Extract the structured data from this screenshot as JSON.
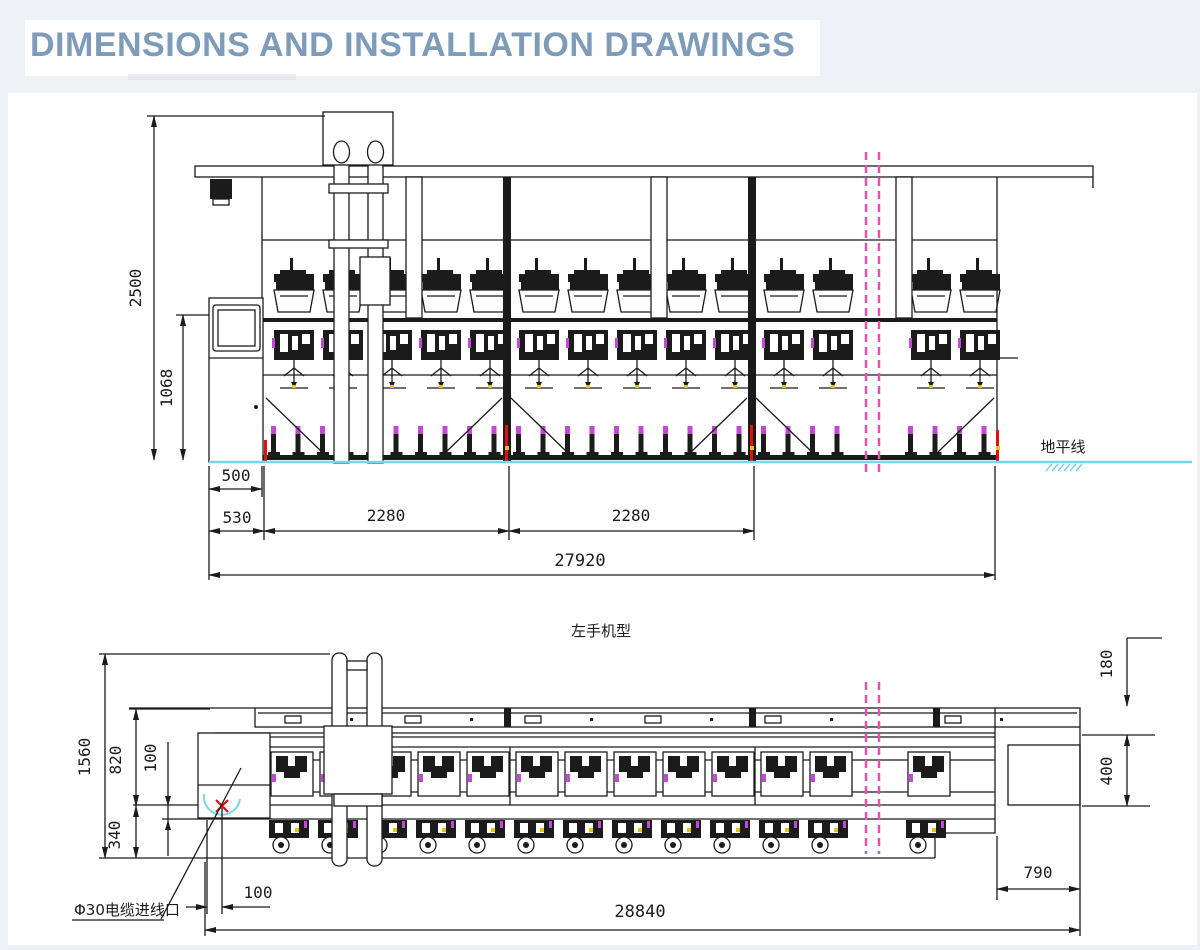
{
  "page": {
    "title": "DIMENSIONS AND INSTALLATION DRAWINGS"
  },
  "colors": {
    "title": "#7e9cba",
    "page_background": "#eef1f5",
    "line": "#1b1b1b",
    "ground_cyan": "#79d5e8",
    "break_magenta": "#e650b2",
    "accent_magenta": "#c24ad2",
    "mark_red": "#e01010",
    "mark_yellow": "#e6c412"
  },
  "top_drawing": {
    "name": "side elevation",
    "ground_label": "地平线",
    "dims": {
      "overall_height": "2500",
      "spindle_height": "1068",
      "cabinet_width": "500",
      "head_section": "530",
      "section_a": "2280",
      "section_b": "2280",
      "overall_length": "27920"
    }
  },
  "bottom_drawing": {
    "view_title": "左手机型",
    "cable_note": "Φ30电缆进线口",
    "dims": {
      "overall_width": "1560",
      "frame_width": "820",
      "inner_offset": "100",
      "rail_offset": "340",
      "top_offset": "180",
      "rail_width": "400",
      "cable_offset": "100",
      "rail_extension": "790",
      "overall_length": "28840"
    }
  }
}
